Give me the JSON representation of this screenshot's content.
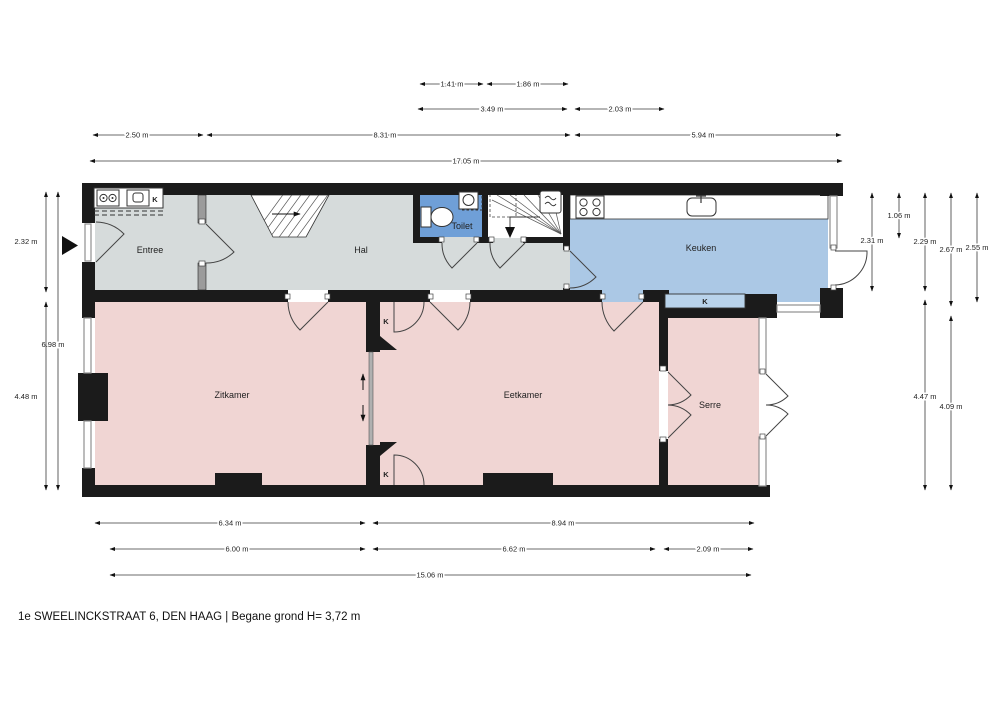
{
  "title": "1e SWEELINCKSTRAAT 6, DEN HAAG | Begane grond H= 3,72 m",
  "rooms": {
    "entree": "Entree",
    "hal": "Hal",
    "toilet": "Toilet",
    "keuken": "Keuken",
    "zitkamer": "Zitkamer",
    "eetkamer": "Eetkamer",
    "serre": "Serre"
  },
  "labels": {
    "closet": "K"
  },
  "dimensions": {
    "top": [
      "1.41 m",
      "1.86 m",
      "3.49 m",
      "2.03 m",
      "2.50 m",
      "8.31 m",
      "5.94 m",
      "17.05 m"
    ],
    "left": [
      "2.32 m",
      "6.98 m",
      "4.48 m"
    ],
    "right": [
      "2.31 m",
      "1.06 m",
      "2.29 m",
      "2.67 m",
      "2.55 m",
      "4.47 m",
      "4.09 m"
    ],
    "bottom": [
      "6.34 m",
      "8.94 m",
      "6.00 m",
      "6.62 m",
      "2.09 m",
      "15.06 m"
    ]
  },
  "colors": {
    "c-wall": "#1b1b1b",
    "c-gray-room": "#d6dbdb",
    "c-pink-room": "#f0d5d3",
    "c-toilet": "#6f9fd7",
    "c-keuken": "#abc8e5",
    "c-kband": "#b9d3eb"
  }
}
